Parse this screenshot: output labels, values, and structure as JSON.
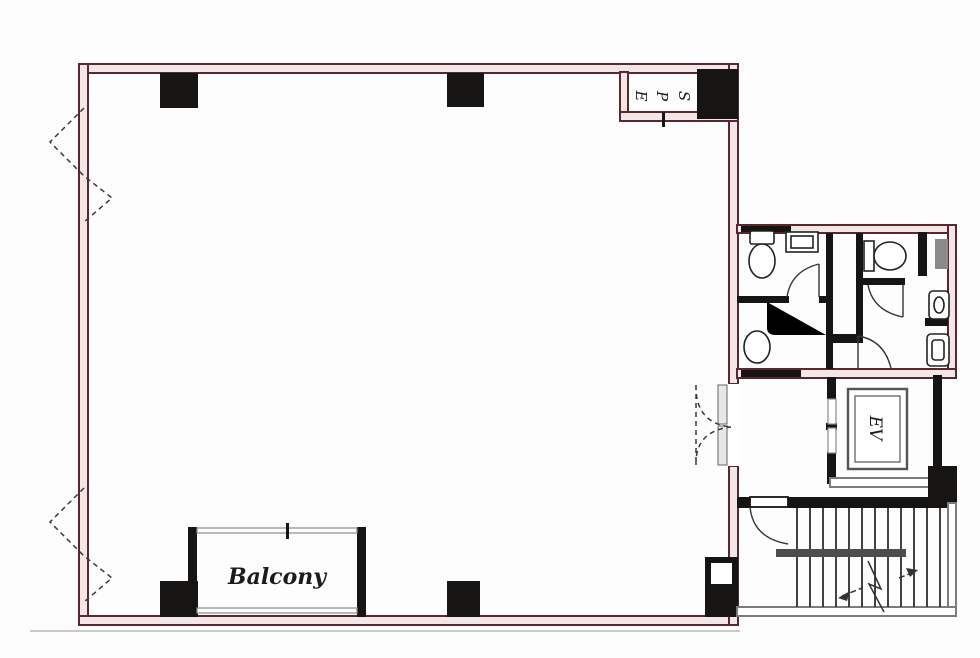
{
  "labels": {
    "eps": [
      "E",
      "P",
      "S"
    ],
    "elevator": "EV",
    "balcony": "Balcony"
  },
  "colors": {
    "wall": "#5a2630",
    "wallfill": "#f2e6e6",
    "ink": "#171513",
    "gray": "#7b7b7b"
  }
}
